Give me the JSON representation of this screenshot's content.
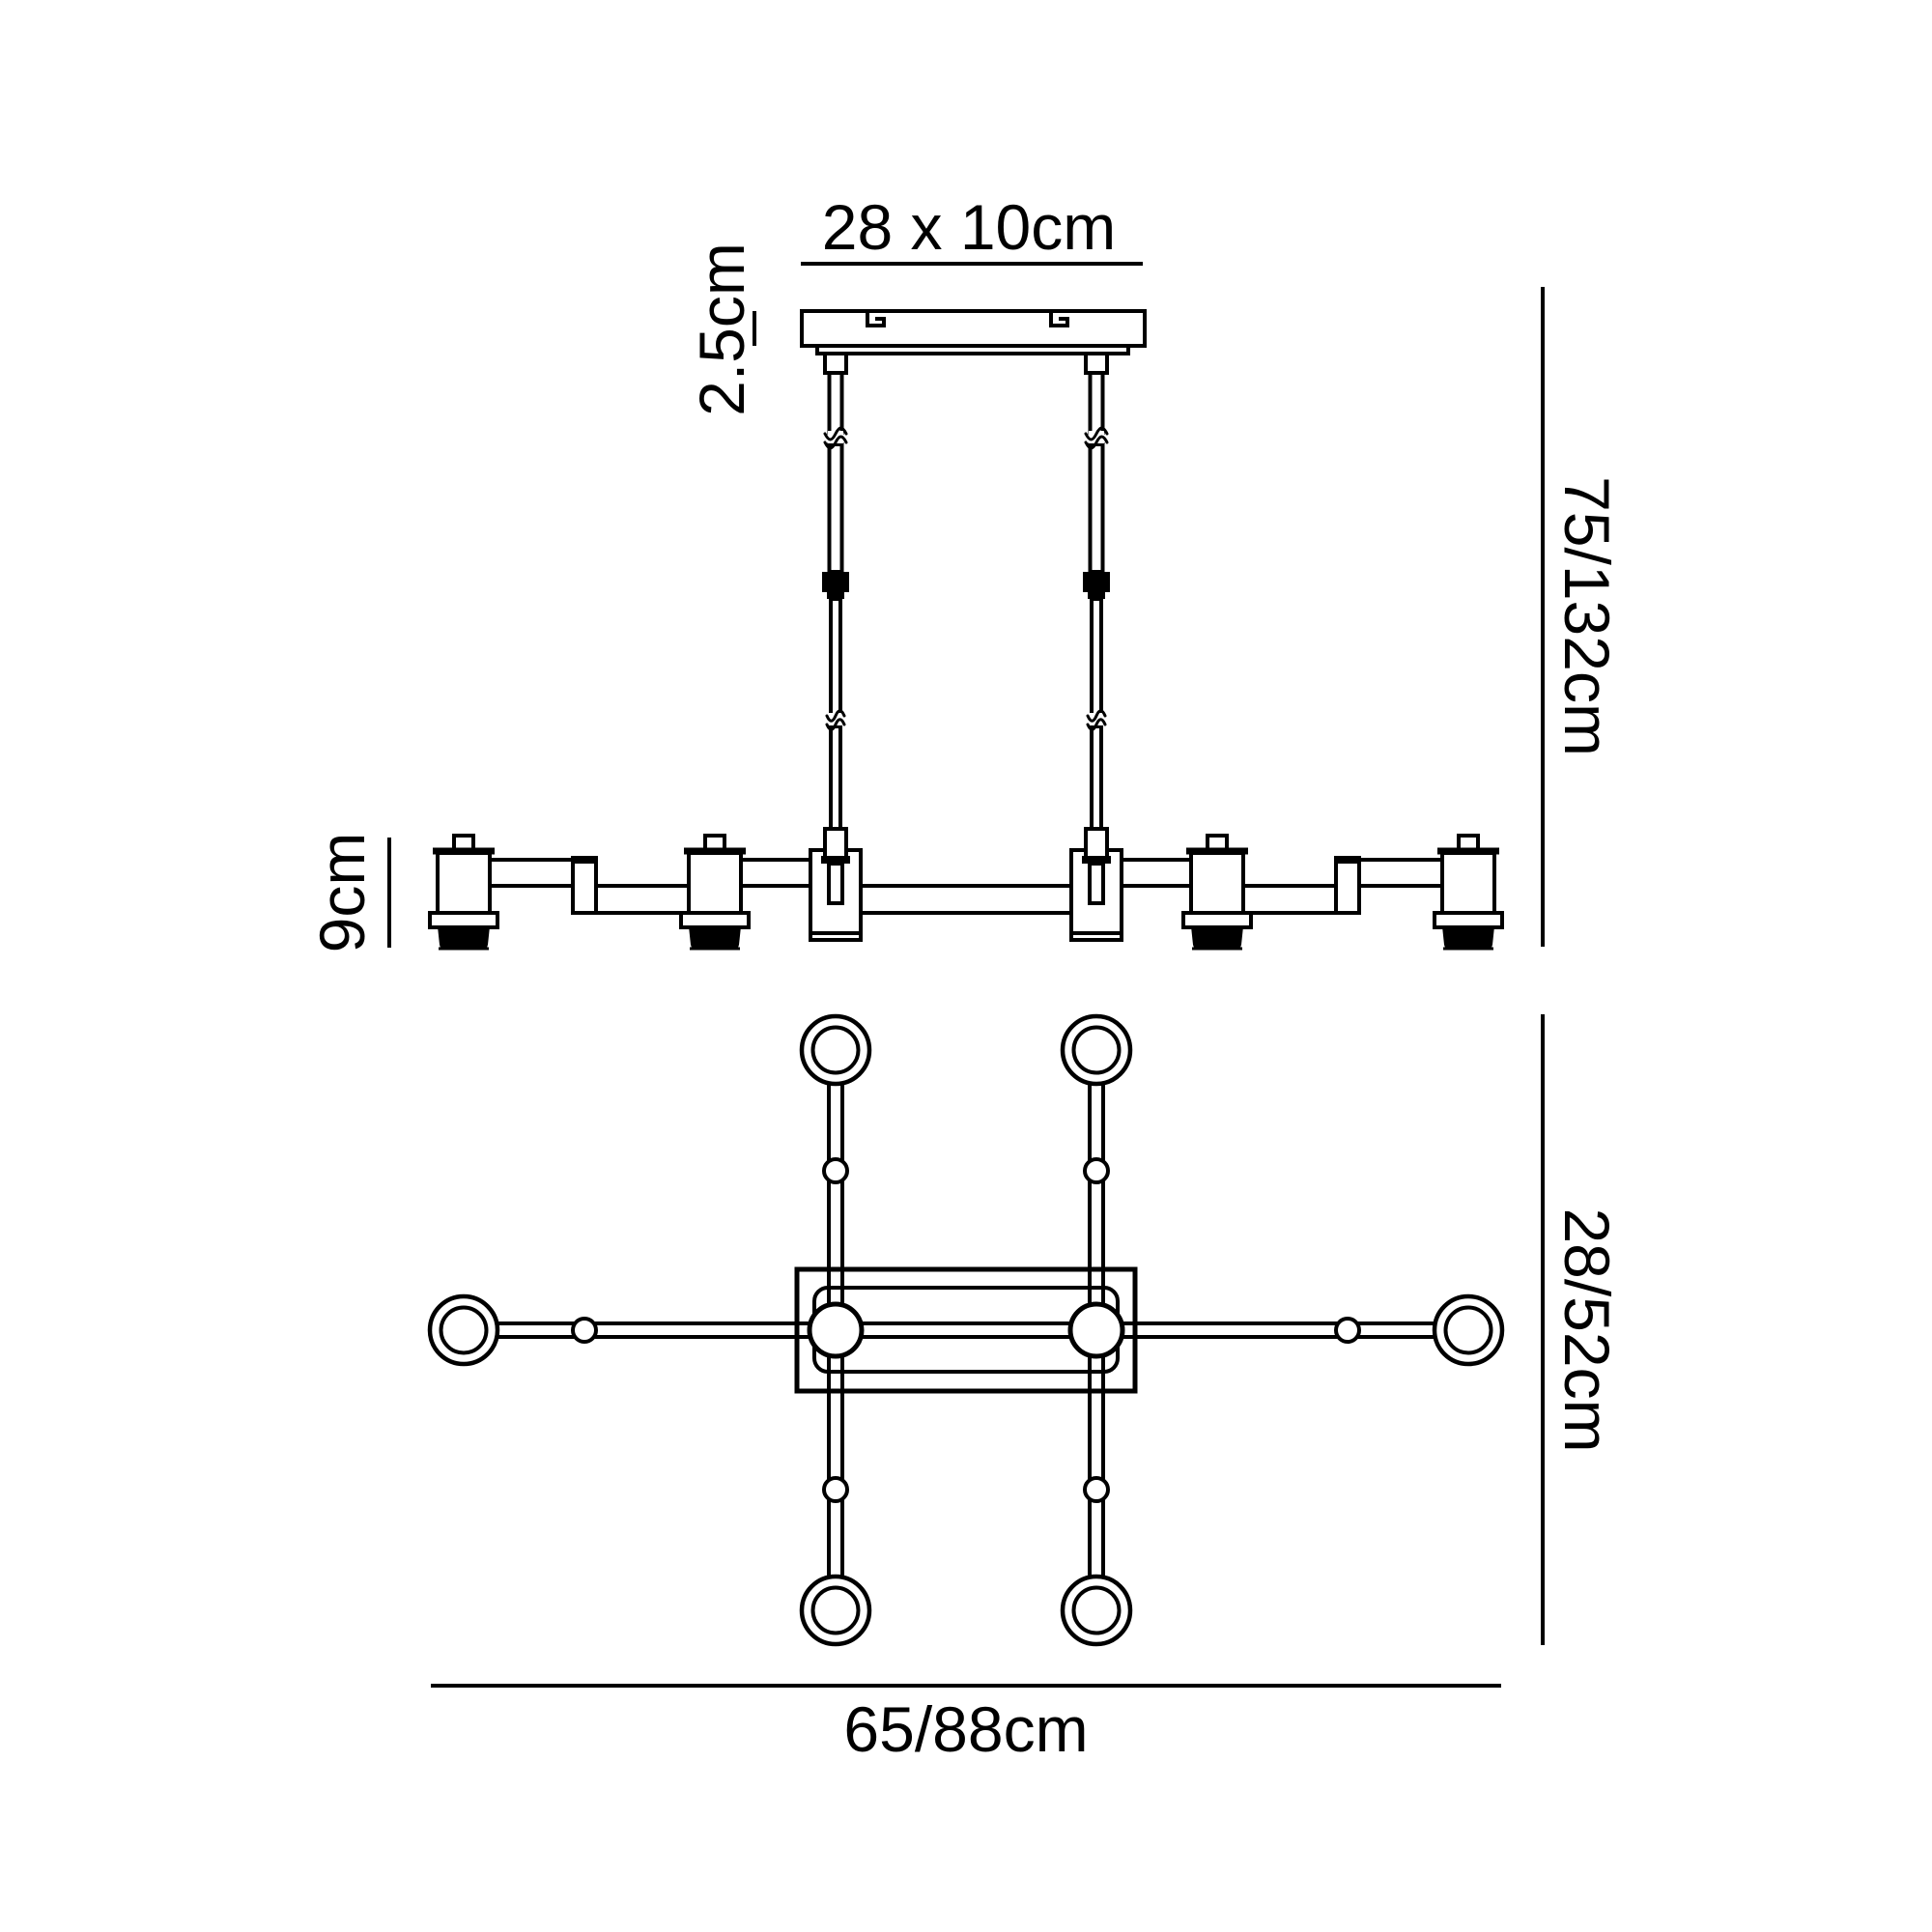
{
  "diagram": {
    "type": "technical-dimension-drawing",
    "subject": "linear pendant light fixture - side elevation and plan view",
    "background_color": "#ffffff",
    "line_color": "#000000",
    "views": {
      "side_elevation": "ceiling canopy with two suspension rods and horizontal bar carrying lamp holders",
      "plan": "central rectangular frame with two hubs, six arms ending in rings"
    },
    "dimensions": {
      "canopy_plate": "28 x 10cm",
      "canopy_thickness": "2.5cm",
      "suspension_drop": "75/132cm",
      "bar_height": "9cm",
      "plan_depth": "28/52cm",
      "plan_width": "65/88cm"
    }
  }
}
